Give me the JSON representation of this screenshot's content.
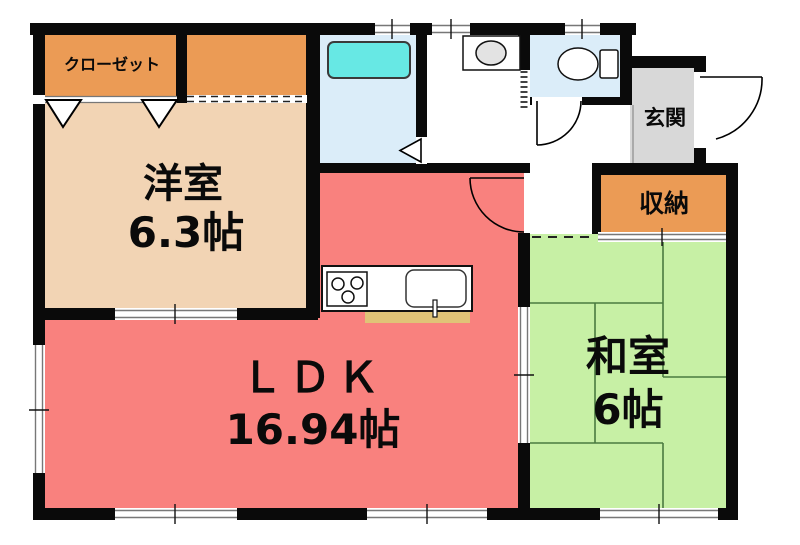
{
  "floor_plan": {
    "kind": "japanese-apartment-floor-plan",
    "labels": {
      "closet": "クローゼット",
      "western_room_name": "洋室",
      "western_room_size": "6.3帖",
      "ldk_name": "ＬＤＫ",
      "ldk_size": "16.94帖",
      "japanese_room_name": "和室",
      "japanese_room_size": "6帖",
      "entrance": "玄関",
      "storage": "収納"
    },
    "fixtures": [
      "bathtub",
      "washbasin",
      "toilet",
      "gas-stove",
      "kitchen-sink"
    ],
    "colors": {
      "wall": "#0a0a0a",
      "closet": "#EB9B55",
      "storage": "#EB9B55",
      "western_room": "#F2D4B4",
      "ldk": "#F9817E",
      "japanese_room": "#C7F0A5",
      "bathroom": "#DBEDF9",
      "toilet_room": "#DBEDF9",
      "bathtub": "#67E8E4",
      "entrance": "#D8D8D8",
      "counter_strip": "#E0C377",
      "tatami_line": "#4a7a40",
      "basin": "#E3E3E3"
    }
  }
}
